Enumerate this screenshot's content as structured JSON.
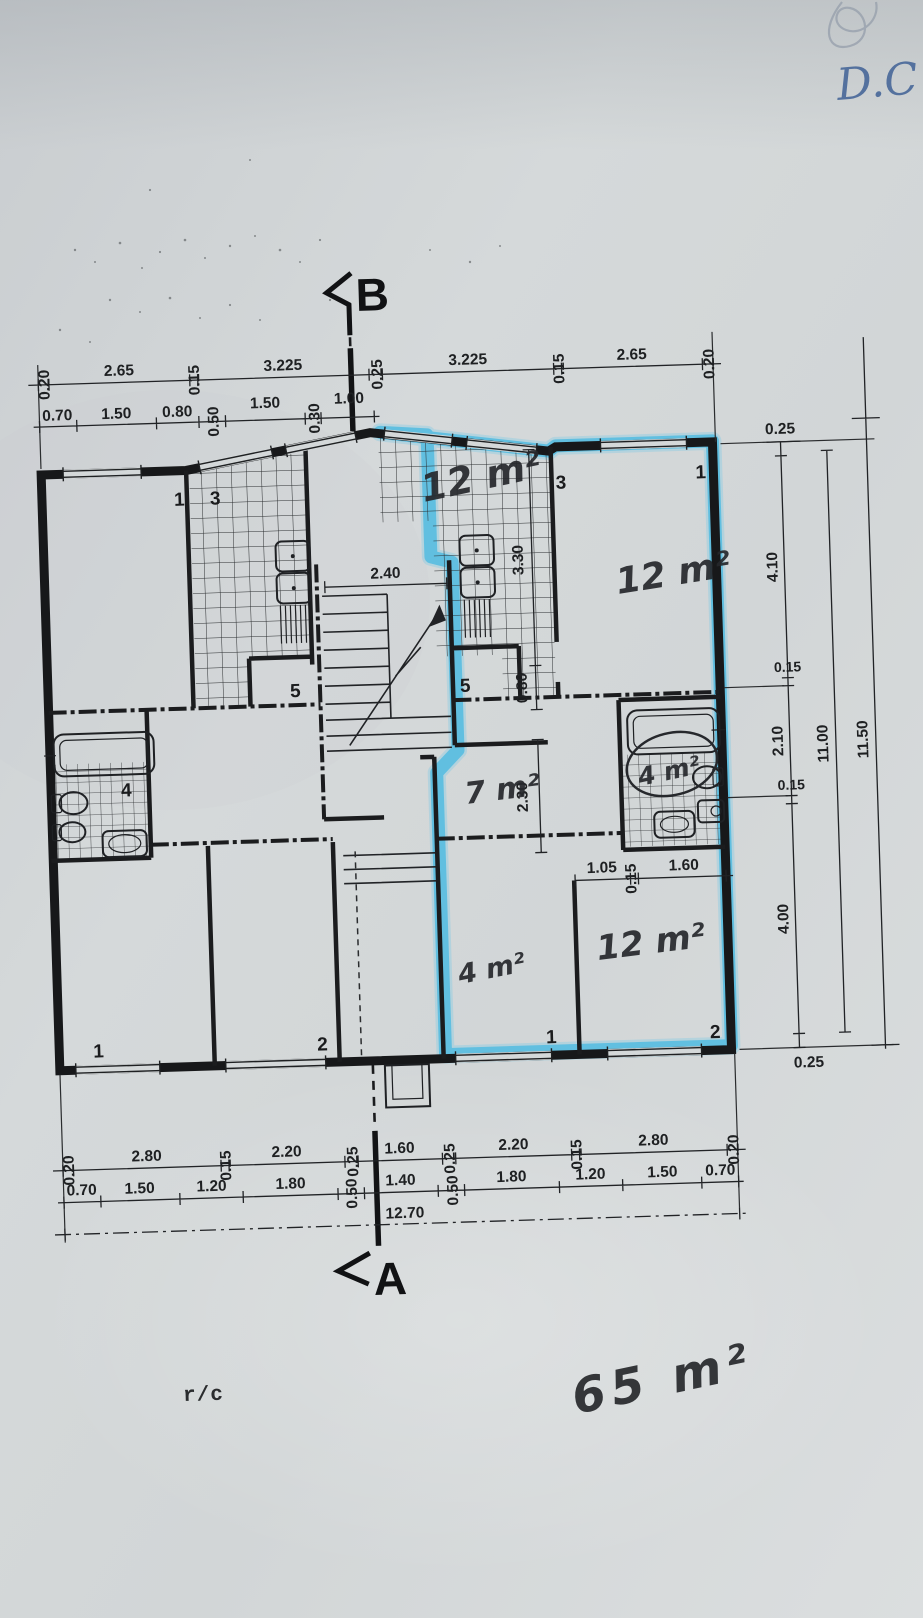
{
  "annotations": {
    "corner_initials": "D.C",
    "section_top": "B",
    "section_bottom": "A",
    "floor_label": "r/c",
    "total_area": "65 m²"
  },
  "areas": {
    "kitchen_center": "12 m²",
    "room_top_right": "12 m²",
    "hall_center": "7 m²",
    "bathroom_right": "4 m²",
    "room_bottom_mid": "4 m²",
    "room_bottom_right": "12 m²"
  },
  "room_numbers": {
    "top_left": "1",
    "kitchen_left": "3",
    "kitchen_center": "3",
    "top_right": "1",
    "stair_left": "5",
    "stair_right": "5",
    "bath_left": "4",
    "bottom_left_1": "1",
    "bottom_left_2": "2",
    "bottom_right_1": "1",
    "bottom_right_2": "2"
  },
  "dims": {
    "top_row1": [
      "0.20",
      "2.65",
      "0.15",
      "3.225",
      "0.25",
      "3.225",
      "0.15",
      "2.65",
      "0.20"
    ],
    "top_row2": [
      "0.70",
      "1.50",
      "0.80",
      "0.50",
      "1.50",
      "0.30",
      "1.00"
    ],
    "bottom_row1": [
      "0.20",
      "2.80",
      "0.15",
      "2.20",
      "0.25",
      "1.60",
      "0.25",
      "2.20",
      "0.15",
      "2.80",
      "0.20"
    ],
    "bottom_row2": [
      "0.70",
      "1.50",
      "1.20",
      "1.80",
      "0.50",
      "1.40",
      "0.50",
      "1.80",
      "1.20",
      "1.50",
      "0.70"
    ],
    "bottom_total": "12.70",
    "right_chain": [
      "0.25",
      "4.10",
      "0.15",
      "2.10",
      "0.15",
      "4.00",
      "0.25"
    ],
    "right_total_inner": "11.00",
    "right_total_outer": "11.50",
    "stair_width": "2.40",
    "kitchen_depth": "3.30",
    "niche_depth": "0.80",
    "hall_depth": "2.30",
    "closet_chain": [
      "1.05",
      "0.15",
      "1.60"
    ]
  }
}
